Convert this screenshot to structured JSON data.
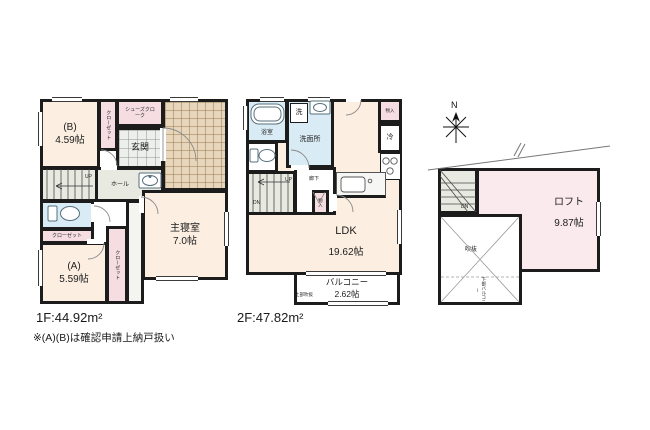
{
  "colors": {
    "wall": "#1c1c1c",
    "room_cream": "#fcefe2",
    "closet_pink": "#f5dde2",
    "loft_pink": "#faeaed",
    "stair_gray": "#e8eae1",
    "water_blue": "#d9ebf4",
    "porch_tile": "#e7d6bb"
  },
  "f1": {
    "caption": "1F:44.92m²",
    "note": "※(A)(B)は確認申請上納戸扱い",
    "labels": {
      "room_b_name": "(B)",
      "room_b_size": "4.59帖",
      "closet_b": "クローゼット",
      "shoe_closet": "シューズクローク",
      "genkan": "玄関",
      "hall": "ホール",
      "up": "UP",
      "closet_toilet": "クローゼット",
      "closet_a": "クローゼット",
      "room_a_name": "(A)",
      "room_a_size": "5.59帖",
      "master_name": "主寝室",
      "master_size": "7.0帖"
    }
  },
  "f2": {
    "caption": "2F:47.82m²",
    "labels": {
      "bath": "浴室",
      "washer": "洗",
      "lavatory": "洗面所",
      "corridor": "廊下",
      "up": "UP",
      "dn": "DN",
      "storage_hall": "物入",
      "storage_top": "物入",
      "fridge": "冷",
      "ldk_name": "LDK",
      "ldk_size": "19.62帖",
      "balcony_name": "バルコニー",
      "balcony_size": "2.62帖",
      "void_above": "上部吹抜"
    }
  },
  "loft": {
    "labels": {
      "north": "N",
      "dn": "DN",
      "loft_name": "ロフト",
      "loft_size": "9.87帖",
      "void": "吹抜",
      "void_note": "下部バルコニー"
    }
  }
}
